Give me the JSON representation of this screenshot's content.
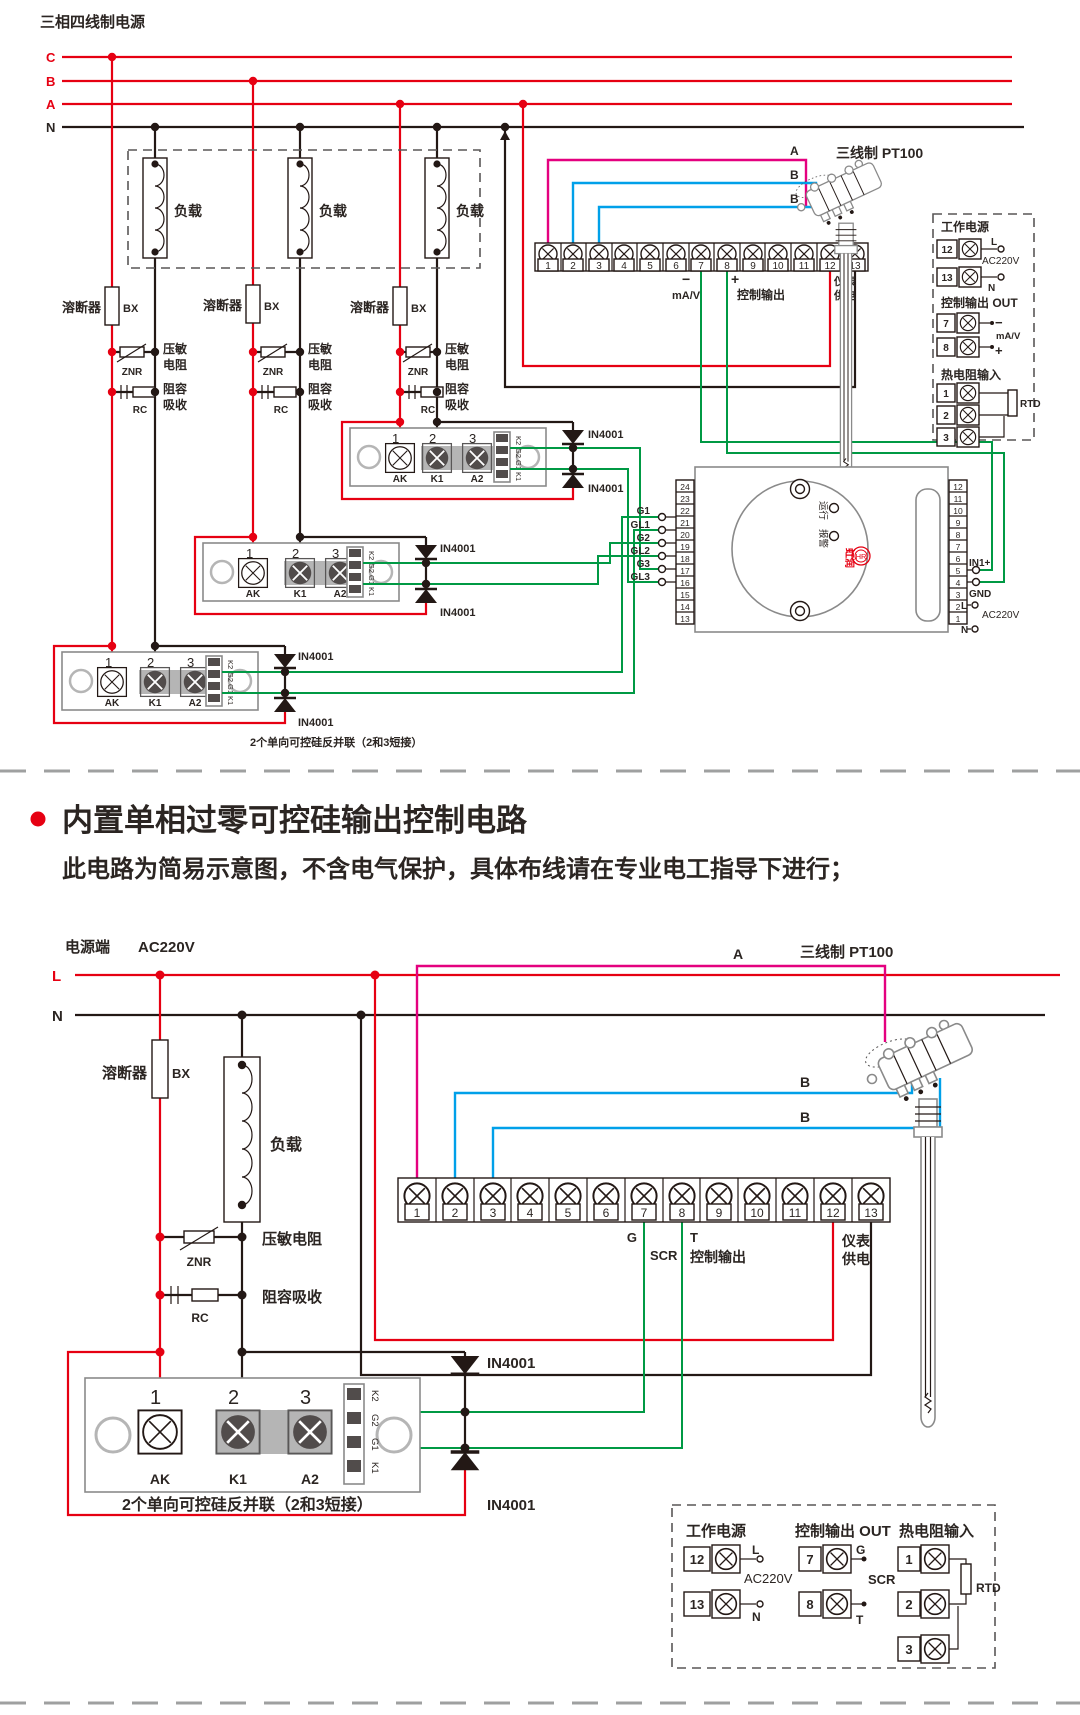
{
  "colors": {
    "phase_red": "#e60012",
    "sensor_a_magenta": "#e4007f",
    "sensor_b_blue": "#00a0e9",
    "gate_green": "#009944",
    "ink": "#231815"
  },
  "shared": {
    "nums": [
      "1",
      "2",
      "3",
      "4",
      "5",
      "6",
      "7",
      "8",
      "9",
      "10",
      "11",
      "12",
      "13"
    ],
    "module": {
      "n1": "1",
      "n2": "2",
      "n3": "3",
      "t1": "AK",
      "t2": "K1",
      "t3": "A2",
      "m1": "K2",
      "m2": "G2",
      "m3": "G1",
      "m4": "K1"
    },
    "diode": "IN4001",
    "caption": "2个单向可控硅反并联（2和3短接）",
    "sensor_title": "三线制 PT100",
    "sensor_a": "A",
    "sensor_b": "B",
    "fuse": "溶断器",
    "fuse_code": "BX",
    "load": "负载",
    "ac": "AC220V"
  },
  "top": {
    "title": "三相四线制电源",
    "c": "C",
    "b": "B",
    "a": "A",
    "n": "N",
    "var1": "压敏",
    "var2": "电阻",
    "var_code": "ZNR",
    "rc1": "阻容",
    "rc2": "吸收",
    "rc_code": "RC",
    "strip": {
      "minus": "−",
      "mav": "mA/V",
      "plus": "+",
      "ctrl": "控制输出",
      "pw1": "仪表",
      "pw2": "供电"
    },
    "gates": {
      "g1": "G1",
      "gl1": "GL1",
      "g2": "G2",
      "gl2": "GL2",
      "g3": "G3",
      "gl3": "GL3"
    },
    "trigger": {
      "left": [
        "24",
        "23",
        "22",
        "21",
        "20",
        "19",
        "18",
        "17",
        "16",
        "15",
        "14",
        "13"
      ],
      "right": [
        "12",
        "11",
        "10",
        "9",
        "8",
        "7",
        "6",
        "5",
        "4",
        "3",
        "2",
        "1"
      ],
      "run": "运行",
      "alarm": "报警",
      "brand": "虹润",
      "logo": "HR",
      "in1": "IN1+",
      "gnd": "GND",
      "l": "L",
      "n": "N"
    },
    "panel": {
      "t1": "工作电源",
      "t2": "控制输出 OUT",
      "t3": "热电阻输入",
      "n12": "12",
      "n13": "13",
      "l": "L",
      "n": "N",
      "n7": "7",
      "n8": "8",
      "minus": "−",
      "plus": "+",
      "sig": "mA/V",
      "r1": "1",
      "r2": "2",
      "r3": "3",
      "rtd": "RTD"
    }
  },
  "heading": {
    "title": "内置单相过零可控硅输出控制电路",
    "subtitle": "此电路为简易示意图，不含电气保护，具体布线请在专业电工指导下进行；"
  },
  "bottom": {
    "source": "电源端",
    "l": "L",
    "n": "N",
    "varistor": "压敏电阻",
    "var_code": "ZNR",
    "rc": "阻容吸收",
    "rc_code": "RC",
    "strip": {
      "g": "G",
      "scr": "SCR",
      "t": "T",
      "ctrl": "控制输出",
      "pw1": "仪表",
      "pw2": "供电"
    },
    "panel": {
      "t1": "工作电源",
      "t2": "控制输出 OUT",
      "t3": "热电阻输入",
      "n12": "12",
      "n13": "13",
      "l": "L",
      "n": "N",
      "n7": "7",
      "n8": "8",
      "g": "G",
      "scr": "SCR",
      "t": "T",
      "r1": "1",
      "r2": "2",
      "r3": "3",
      "rtd": "RTD"
    }
  }
}
